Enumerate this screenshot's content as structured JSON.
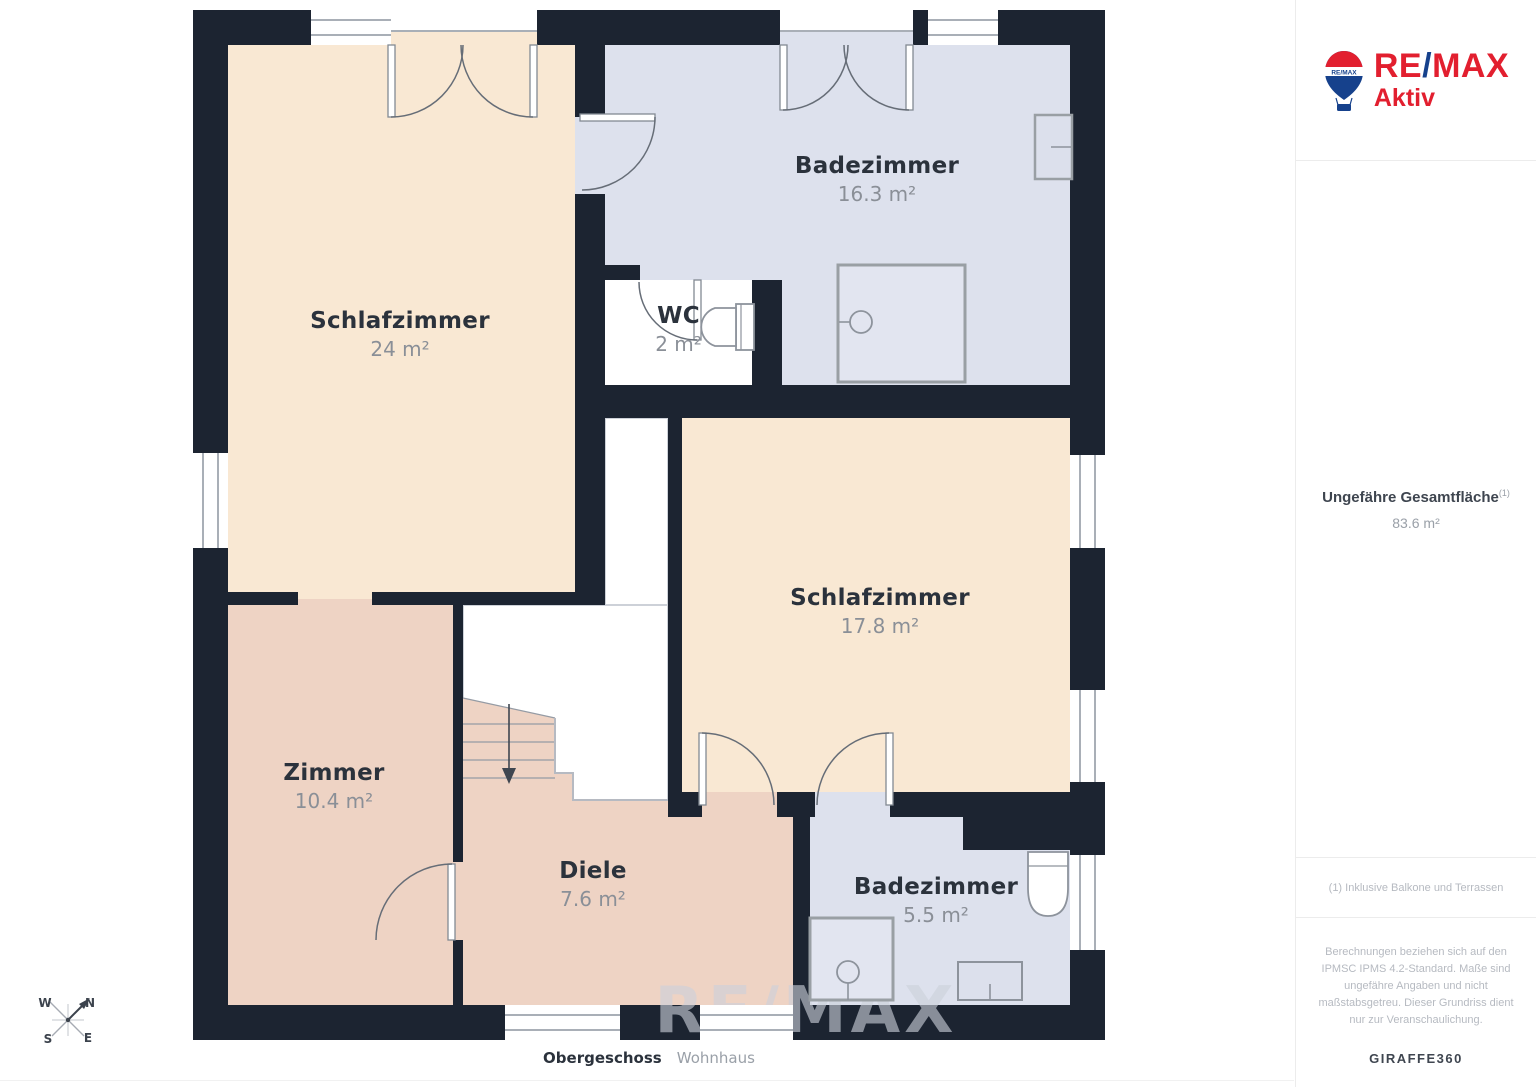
{
  "page": {
    "caption_floor": "Obergeschoss",
    "caption_building": "Wohnhaus",
    "watermark": "RE/MAX"
  },
  "branding": {
    "logo_re": "RE",
    "logo_slash": "/",
    "logo_max": "MAX",
    "office_name": "Aktiv",
    "balloon_label": "RE/MAX",
    "color_red": "#e21f2f",
    "color_blue": "#16418c"
  },
  "sidebar": {
    "total_area_label": "Ungefähre Gesamtfläche",
    "total_area_footnote_marker": "(1)",
    "total_area_value": "83.6 m²",
    "footnote": "(1) Inklusive Balkone und Terrassen",
    "disclaimer": "Berechnungen beziehen sich auf den IPMSC IPMS 4.2-Standard. Maße sind ungefähre Angaben und nicht maßstabsgetreu. Dieser Grundriss dient nur zur Veranschaulichung.",
    "generator_name": "GIRAFFE",
    "generator_suffix": "360"
  },
  "floorplan": {
    "rooms": [
      {
        "name": "Schlafzimmer",
        "area": "24 m²"
      },
      {
        "name": "Badezimmer",
        "area": "16.3 m²"
      },
      {
        "name": "WC",
        "area": "2 m²"
      },
      {
        "name": "Schlafzimmer",
        "area": "17.8 m²"
      },
      {
        "name": "Zimmer",
        "area": "10.4 m²"
      },
      {
        "name": "Diele",
        "area": "7.6 m²"
      },
      {
        "name": "Badezimmer",
        "area": "5.5 m²"
      }
    ],
    "colors": {
      "wall": "#1c2431",
      "bedroom_floor": "#f9e8d3",
      "hall_floor": "#eed3c4",
      "bath_floor": "#dde1ed",
      "stairwell": "#ffffff"
    }
  },
  "compass": {
    "north": "N",
    "east": "E",
    "south": "S",
    "west": "W"
  }
}
